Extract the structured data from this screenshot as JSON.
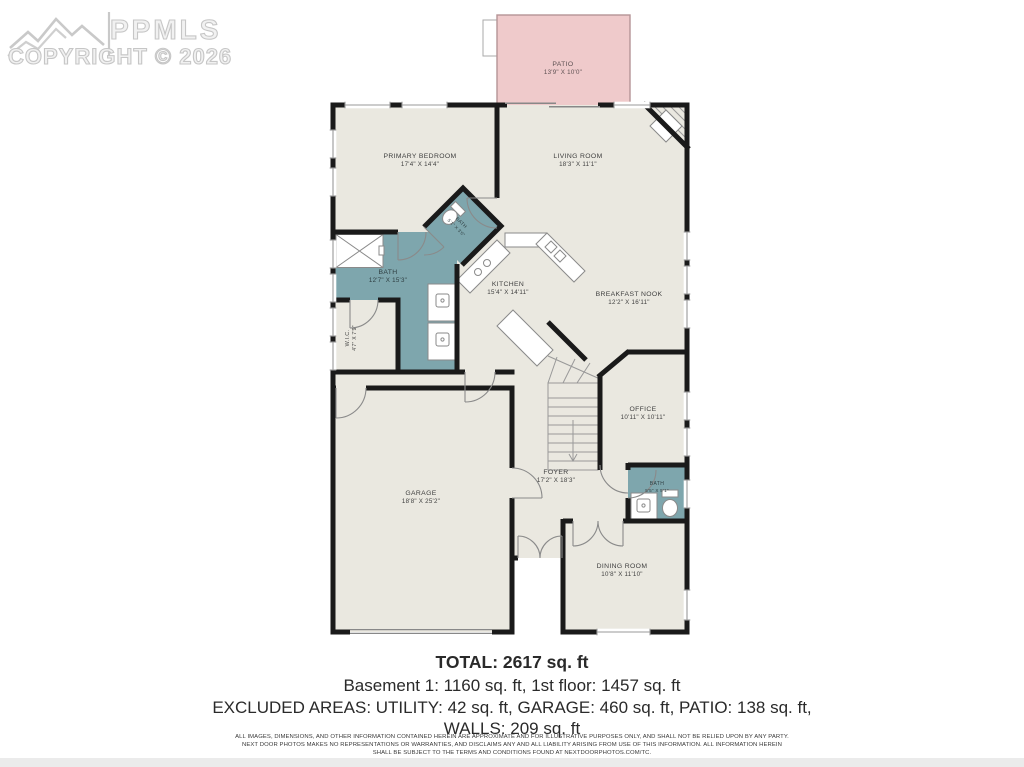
{
  "watermark": {
    "brand": "PPMLS",
    "copyright": "COPYRIGHT © 2026"
  },
  "colors": {
    "floor": "#eae8e0",
    "bath": "#7ea6ad",
    "patio": "#efcacb",
    "wall": "#1a1a1a",
    "detail": "#8a8a8a"
  },
  "rooms": [
    {
      "id": "patio",
      "name": "PATIO",
      "dims": "13'9\" X 10'0\""
    },
    {
      "id": "primary-bedroom",
      "name": "PRIMARY BEDROOM",
      "dims": "17'4\" X 14'4\""
    },
    {
      "id": "living-room",
      "name": "LIVING ROOM",
      "dims": "18'3\" X 11'1\""
    },
    {
      "id": "primary-bath",
      "name": "BATH",
      "dims": "12'7\" X 15'3\""
    },
    {
      "id": "toilet-bath",
      "name": "BATH",
      "dims": "5'1\" X 3'0\""
    },
    {
      "id": "wic",
      "name": "W.I.C.",
      "dims": "4'7\" X 7'9\""
    },
    {
      "id": "kitchen",
      "name": "KITCHEN",
      "dims": "15'4\" X 14'11\""
    },
    {
      "id": "breakfast-nook",
      "name": "BREAKFAST NOOK",
      "dims": "12'2\" X 16'11\""
    },
    {
      "id": "office",
      "name": "OFFICE",
      "dims": "10'11\" X 10'11\""
    },
    {
      "id": "foyer",
      "name": "FOYER",
      "dims": "17'2\" X 18'3\""
    },
    {
      "id": "bath-2",
      "name": "BATH",
      "dims": "5'5\" X 5'1\""
    },
    {
      "id": "garage",
      "name": "GARAGE",
      "dims": "18'8\" X 25'2\""
    },
    {
      "id": "dining-room",
      "name": "DINING ROOM",
      "dims": "10'8\" X 11'10\""
    }
  ],
  "summary": {
    "total": "TOTAL: 2617 sq. ft",
    "line2": "Basement 1: 1160 sq. ft, 1st floor: 1457 sq. ft",
    "line3": "EXCLUDED AREAS: UTILITY: 42 sq. ft, GARAGE: 460 sq. ft, PATIO: 138 sq. ft,",
    "line4": "WALLS: 209 sq. ft"
  },
  "disclaimer": {
    "lines": [
      "ALL IMAGES, DIMENSIONS, AND OTHER INFORMATION CONTAINED HEREIN ARE APPROXIMATE AND FOR ILLUSTRATIVE PURPOSES ONLY, AND SHALL NOT BE RELIED UPON BY ANY PARTY.",
      "NEXT DOOR PHOTOS MAKES NO REPRESENTATIONS OR WARRANTIES, AND DISCLAIMS ANY AND ALL LIABILITY ARISING FROM USE OF THIS INFORMATION. ALL INFORMATION HEREIN",
      "SHALL BE SUBJECT TO THE TERMS AND CONDITIONS FOUND AT NEXTDOORPHOTOS.COM/TC."
    ]
  }
}
